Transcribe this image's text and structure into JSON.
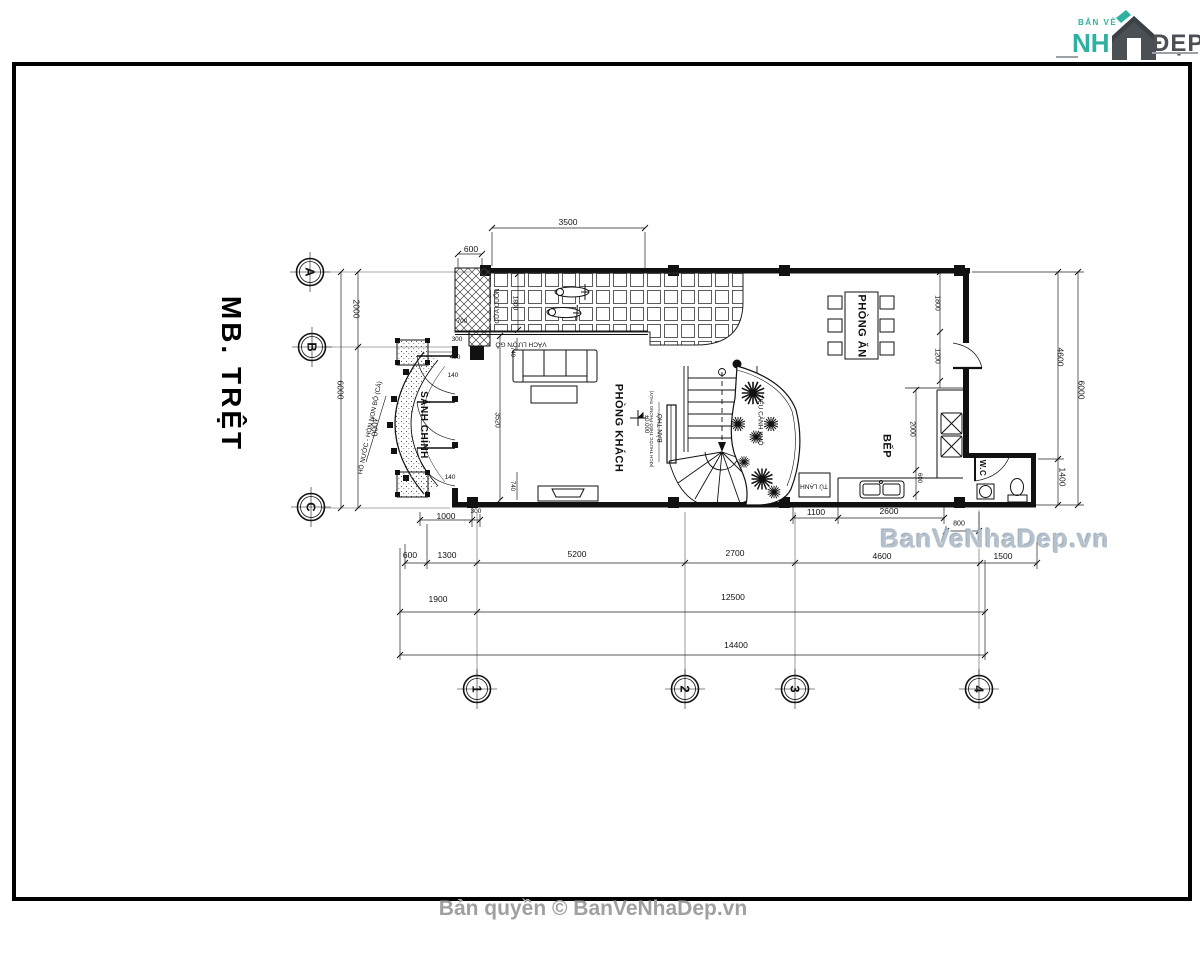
{
  "logo": {
    "top": "BẢN VẼ",
    "name_left": "NH",
    "name_right": "ĐẸP"
  },
  "title": "MB. TRỆT",
  "watermark": "BanVeNhaDep.vn",
  "copyright": "Bản quyền © BanVeNhaDep.vn",
  "colors": {
    "teal": "#2fb0a0",
    "logo_dark": "#4b5055",
    "watermark": "#b5c2cd",
    "copyright": "#a0a0a0",
    "line": "#111111"
  },
  "plan": {
    "grid": [
      {
        "t": "A",
        "x": 310,
        "y": 272,
        "r": 90
      },
      {
        "t": "B",
        "x": 312,
        "y": 347,
        "r": 90
      },
      {
        "t": "C",
        "x": 311,
        "y": 507,
        "r": 90
      },
      {
        "t": "1",
        "x": 477,
        "y": 689,
        "r": 90
      },
      {
        "t": "2",
        "x": 685,
        "y": 689,
        "r": 90
      },
      {
        "t": "3",
        "x": 795,
        "y": 689,
        "r": 90
      },
      {
        "t": "4",
        "x": 979,
        "y": 689,
        "r": 90
      }
    ],
    "rooms": [
      {
        "t": "SẢNH CHÍNH",
        "x": 423,
        "y": 425,
        "r": 90,
        "s": 10
      },
      {
        "t": "PHÒNG KHÁCH",
        "x": 618,
        "y": 428,
        "r": 90,
        "s": 11
      },
      {
        "t": "PHÒNG ĂN",
        "x": 861,
        "y": 326,
        "r": 90,
        "s": 11
      },
      {
        "t": "BẾP",
        "x": 886,
        "y": 446,
        "r": 90,
        "s": 11
      },
      {
        "t": "W.C",
        "x": 982,
        "y": 468,
        "r": 90,
        "s": 8
      }
    ],
    "notes": [
      {
        "t": "CỬA CUỐN",
        "x": 498,
        "y": 306,
        "r": -90
      },
      {
        "t": "VÁCH LƯỢN GỖ",
        "x": 521,
        "y": 343,
        "r": 180
      },
      {
        "t": "BÀN THỜ",
        "x": 661,
        "y": 428,
        "r": -90
      },
      {
        "t": "(KÍCH THƯỚC THEO PHONG THỦY)",
        "x": 652,
        "y": 429,
        "r": -90,
        "s": 4.5
      },
      {
        "t": "TIỂU CẢNH KHÔ",
        "x": 759,
        "y": 420,
        "r": 90
      },
      {
        "t": "TỦ LẠNH",
        "x": 814,
        "y": 485,
        "r": 180
      },
      {
        "t": "HỒ NƯỚC - HÒN NON BỘ (CÁ)",
        "x": 371,
        "y": 428,
        "r": -78
      },
      {
        "t": "±0.000",
        "x": 646,
        "y": 424,
        "r": 90,
        "s": 6
      }
    ],
    "dims": [
      {
        "t": "3500",
        "x": 568,
        "y": 222
      },
      {
        "t": "600",
        "x": 471,
        "y": 249
      },
      {
        "t": "700",
        "x": 462,
        "y": 322,
        "s": 6.5
      },
      {
        "t": "300",
        "x": 457,
        "y": 340,
        "s": 6.5
      },
      {
        "t": "400",
        "x": 455,
        "y": 358,
        "s": 6.5
      },
      {
        "t": "140",
        "x": 453,
        "y": 376,
        "s": 6.5
      },
      {
        "t": "140",
        "x": 450,
        "y": 478,
        "s": 6.5
      },
      {
        "t": "1800",
        "x": 514,
        "y": 303,
        "r": 90,
        "s": 6.5
      },
      {
        "t": "2000",
        "x": 356,
        "y": 309,
        "r": 90
      },
      {
        "t": "6000",
        "x": 340,
        "y": 390,
        "r": 90
      },
      {
        "t": "4000",
        "x": 374,
        "y": 427,
        "r": 90
      },
      {
        "t": "3520",
        "x": 497,
        "y": 420,
        "r": 90,
        "s": 7
      },
      {
        "t": "740",
        "x": 512,
        "y": 352,
        "r": 90,
        "s": 6
      },
      {
        "t": "740",
        "x": 512,
        "y": 486,
        "r": 90,
        "s": 6
      },
      {
        "t": "1800",
        "x": 937,
        "y": 303,
        "r": 90,
        "s": 7
      },
      {
        "t": "1200",
        "x": 937,
        "y": 356,
        "r": 90,
        "s": 7
      },
      {
        "t": "2000",
        "x": 912,
        "y": 429,
        "r": 90,
        "s": 7
      },
      {
        "t": "600",
        "x": 919,
        "y": 478,
        "r": 90,
        "s": 6
      },
      {
        "t": "4600",
        "x": 1060,
        "y": 357,
        "r": 90
      },
      {
        "t": "6000",
        "x": 1081,
        "y": 390,
        "r": 90
      },
      {
        "t": "1400",
        "x": 1062,
        "y": 477,
        "r": 90
      },
      {
        "t": "1000",
        "x": 446,
        "y": 516
      },
      {
        "t": "300",
        "x": 476,
        "y": 512,
        "s": 6.5
      },
      {
        "t": "1100",
        "x": 816,
        "y": 512
      },
      {
        "t": "2600",
        "x": 889,
        "y": 511
      },
      {
        "t": "800",
        "x": 959,
        "y": 524,
        "s": 7
      },
      {
        "t": "600",
        "x": 410,
        "y": 555
      },
      {
        "t": "1300",
        "x": 447,
        "y": 555
      },
      {
        "t": "5200",
        "x": 577,
        "y": 554
      },
      {
        "t": "2700",
        "x": 735,
        "y": 553
      },
      {
        "t": "4600",
        "x": 882,
        "y": 556
      },
      {
        "t": "1500",
        "x": 1003,
        "y": 556
      },
      {
        "t": "1900",
        "x": 438,
        "y": 599
      },
      {
        "t": "12500",
        "x": 733,
        "y": 597
      },
      {
        "t": "14400",
        "x": 736,
        "y": 645
      }
    ]
  }
}
